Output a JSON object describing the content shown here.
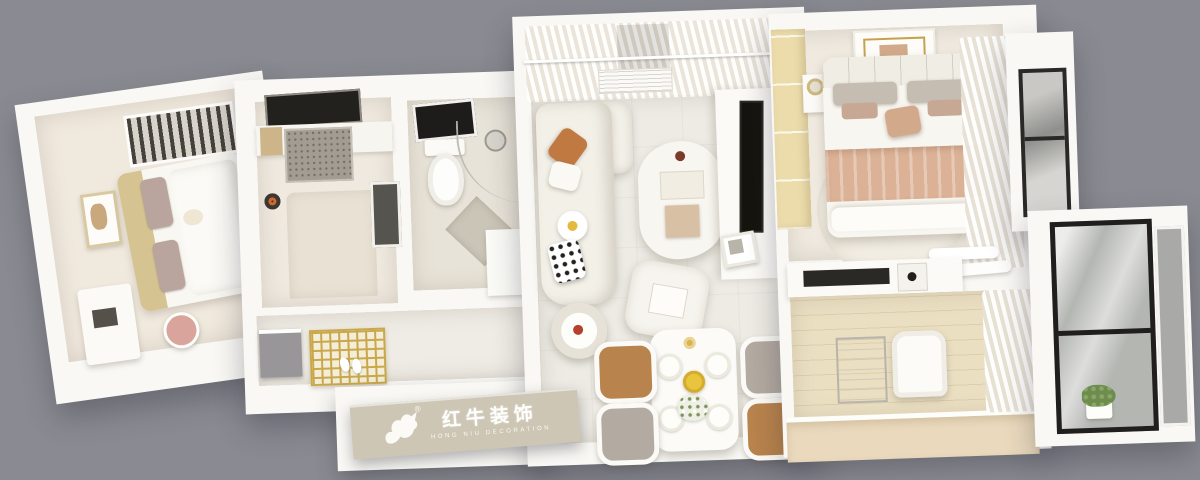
{
  "image": {
    "kind": "3d-apartment-floorplan-top-view-render",
    "background_color": "#8a8b92",
    "wall_color": "#f9f8f4"
  },
  "brand": {
    "name_cn": "红牛装饰",
    "name_en": "HONG NIU DECORATION",
    "registered": "®",
    "plate_color": "#cdc6b5",
    "text_color": "#ffffff",
    "logo_icon": "bull-icon"
  },
  "rooms": [
    {
      "id": "second-bedroom",
      "area": "left-wing",
      "furniture": [
        "wardrobe-with-clothes",
        "double-bed",
        "tan-headboard-cushions",
        "picture-frame",
        "desk",
        "pink-chair"
      ]
    },
    {
      "id": "kitchen",
      "area": "center-left",
      "furniture": [
        "dark-cooktop-window",
        "counter",
        "terrazzo-worktop",
        "cutting-board",
        "island-counter",
        "fridge",
        "pot"
      ]
    },
    {
      "id": "bathroom",
      "area": "center",
      "furniture": [
        "wall-mirror",
        "toilet",
        "shower-head",
        "curved-glass-partition",
        "floor-mat",
        "vanity"
      ]
    },
    {
      "id": "entry-hall",
      "area": "center-bottom",
      "furniture": [
        "gray-shoe-cabinet",
        "gold-lattice-screen",
        "slippers"
      ]
    },
    {
      "id": "living-room",
      "area": "center",
      "furniture": [
        "sheer-curtains",
        "window",
        "air-conditioner",
        "white-sectional-sofa",
        "orange-pillow",
        "daisy-pillow",
        "dotted-pillow",
        "blob-coffee-table",
        "ottoman",
        "round-side-table",
        "tv",
        "tv-console",
        "photo-frame"
      ]
    },
    {
      "id": "dining-area",
      "area": "center-bottom",
      "furniture": [
        "white-dining-table",
        "leather-chair",
        "gray-chair",
        "plates",
        "yellow-fruit-bowl",
        "flower-bouquet"
      ]
    },
    {
      "id": "master-bedroom",
      "area": "right",
      "furniture": [
        "wood-wardrobe",
        "gold-rim-ceiling-lamp",
        "nightstand-lamp",
        "double-bed",
        "rose-blanket",
        "throw-pillow",
        "round-rug",
        "wavy-curtains",
        "balcony-window"
      ]
    },
    {
      "id": "study",
      "area": "right-bottom",
      "furniture": [
        "equipment-shelf",
        "wire-rack",
        "office-chair",
        "wood-desk",
        "wavy-curtains"
      ]
    },
    {
      "id": "balcony-bay",
      "area": "far-right",
      "furniture": [
        "dark-frame-floor-window",
        "green-plant",
        "glass-pane"
      ]
    }
  ],
  "palette": {
    "floor_light": "#edeae3",
    "floor_beige": "#f0e9de",
    "wood_floor": "#ebdfc2",
    "wardrobe_wood": "#ecdcab",
    "blanket_rose": "#dcb296",
    "pillow_orange": "#c07a41",
    "chair_leather": "#b8834c",
    "chair_gray": "#b3aaa1",
    "gold": "#c9a84c",
    "window_frame": "#242321",
    "fruit_bowl_yellow": "#e8c53c",
    "plant_green": "#6d8c4e"
  }
}
